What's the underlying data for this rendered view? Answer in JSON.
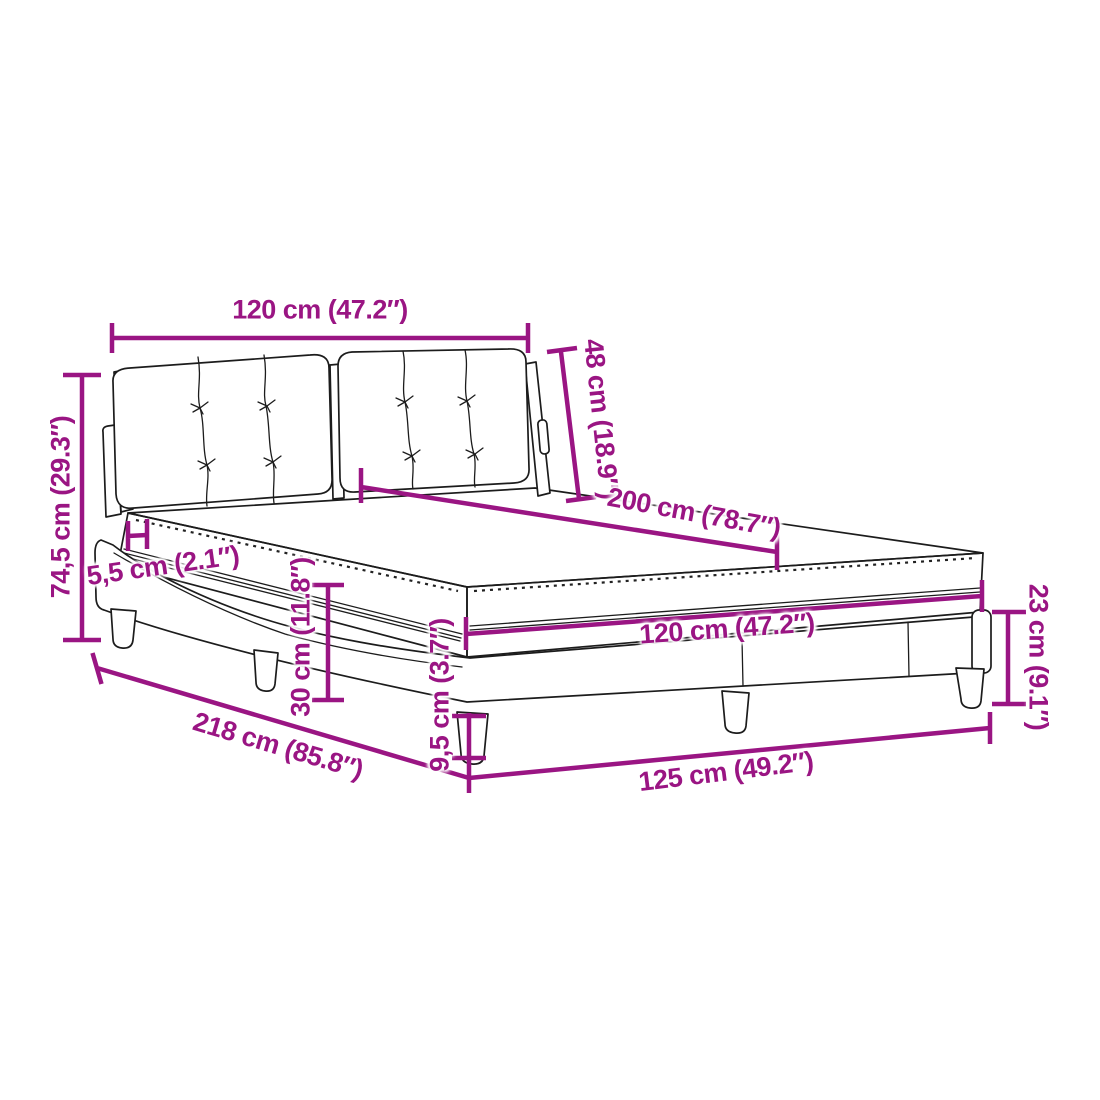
{
  "diagram": {
    "type": "product-dimension-diagram",
    "subject": "bed-with-mattress",
    "colors": {
      "accent": "#9a1583",
      "ink": "#1c1c1c",
      "background": "#ffffff"
    },
    "dimensions": {
      "headboard_width": {
        "measures": "headboard width",
        "label": "120 cm (47.2″)"
      },
      "headboard_height": {
        "measures": "headboard height",
        "label": "48 cm (18.9″)"
      },
      "bed_length": {
        "measures": "mattress length",
        "label": "200 cm (78.7″)"
      },
      "overall_height": {
        "measures": "overall height",
        "label": "74,5 cm (29.3″)"
      },
      "topper_thickness": {
        "measures": "mattress top layer",
        "label": "5,5 cm (2.1″)"
      },
      "base_height": {
        "measures": "base frame height",
        "label": "30 cm (11.8″)"
      },
      "mattress_width": {
        "measures": "mattress width",
        "label": "120 cm (47.2″)"
      },
      "foot_height": {
        "measures": "foot end height",
        "label": "23 cm (9.1″)"
      },
      "leg_height": {
        "measures": "leg height",
        "label": "9,5 cm (3.7″)"
      },
      "overall_length": {
        "measures": "overall length",
        "label": "218 cm (85.8″)"
      },
      "overall_width": {
        "measures": "overall width",
        "label": "125 cm (49.2″)"
      }
    }
  }
}
